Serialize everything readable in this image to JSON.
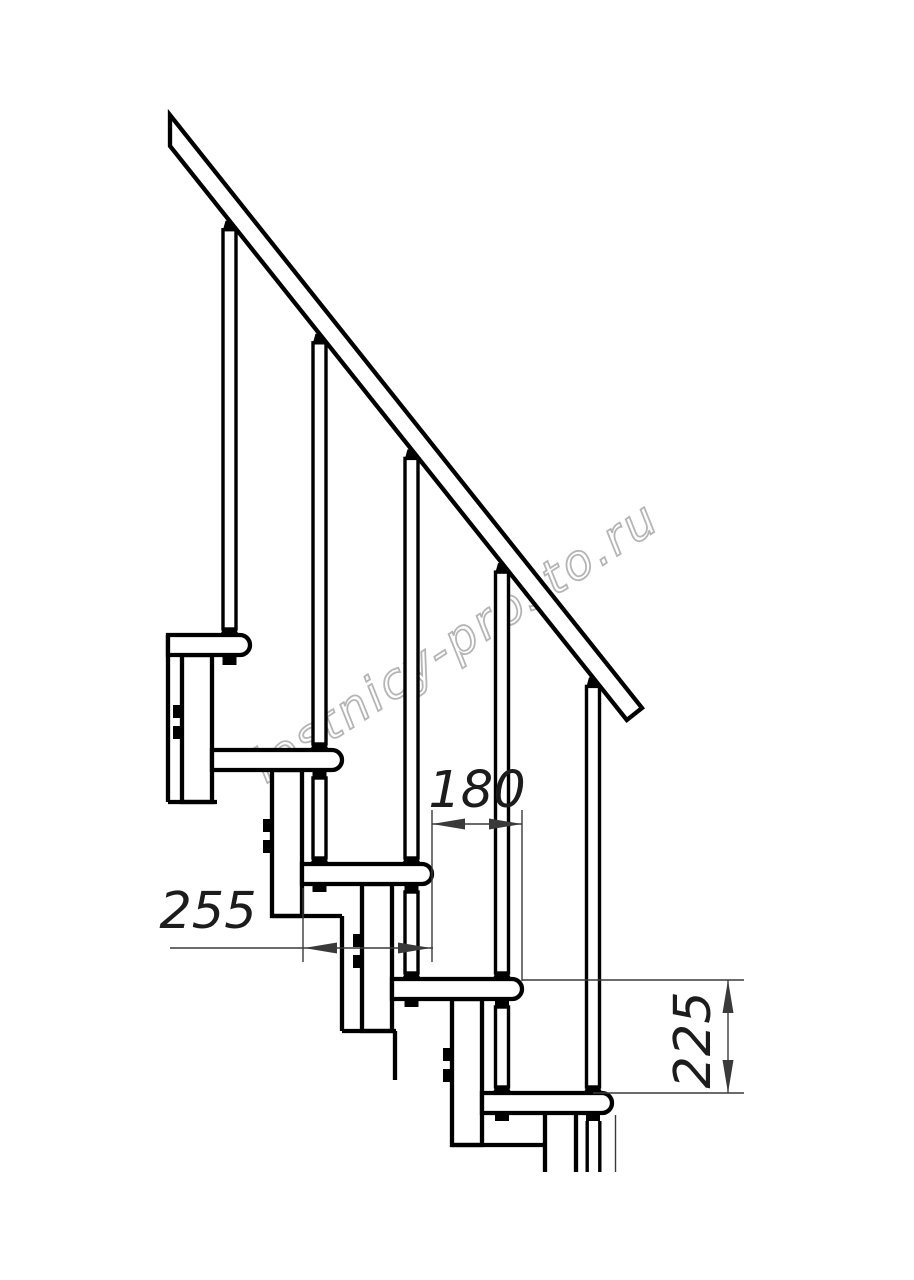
{
  "watermark": {
    "text": "lestnicy-prosto.ru"
  },
  "dimensions": {
    "step_run": {
      "value": "180"
    },
    "tread_depth": {
      "value": "255"
    },
    "riser_height": {
      "value": "225"
    }
  },
  "colors": {
    "line": "#000000",
    "background": "#ffffff",
    "dim_lines": "#3a3a3a",
    "dim_text": "#1c1c1c",
    "watermark": "#b5b5b5"
  }
}
